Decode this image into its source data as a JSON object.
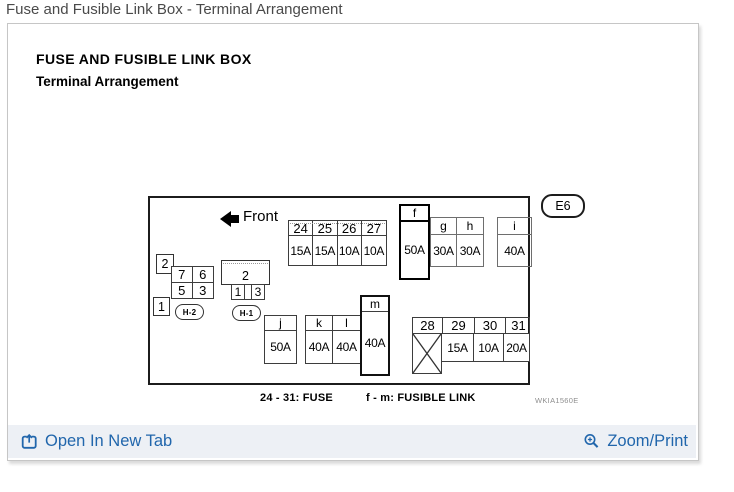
{
  "page_title": "Fuse and Fusible Link Box - Terminal Arrangement",
  "panel": {
    "title_line1": "FUSE AND FUSIBLE LINK BOX",
    "title_line2": "Terminal Arrangement"
  },
  "diagram": {
    "front_label": "Front",
    "badge": "E6",
    "watermark": "WKIA1560E",
    "legend_fuse": "24 - 31: FUSE",
    "legend_fusible": "f - m: FUSIBLE LINK",
    "fuse_top": {
      "ids": [
        "24",
        "25",
        "26",
        "27"
      ],
      "amps": [
        "15A",
        "15A",
        "10A",
        "10A"
      ]
    },
    "fuse_bottom": {
      "ids": [
        "28",
        "29",
        "30",
        "31"
      ],
      "amps": [
        "",
        "15A",
        "10A",
        "20A"
      ],
      "crossed_cell_id": "28"
    },
    "links": {
      "f": {
        "label": "f",
        "amp": "50A"
      },
      "g": {
        "label": "g",
        "amp": "30A"
      },
      "h": {
        "label": "h",
        "amp": "30A"
      },
      "i": {
        "label": "i",
        "amp": "40A"
      },
      "j": {
        "label": "j",
        "amp": "50A"
      },
      "k": {
        "label": "k",
        "amp": "40A"
      },
      "l": {
        "label": "l",
        "amp": "40A"
      },
      "m": {
        "label": "m",
        "amp": "40A"
      }
    },
    "relay_h2": {
      "tag_top": "2",
      "tag_bottom": "1",
      "cells": [
        "7",
        "6",
        "5",
        "3"
      ],
      "name": "H-2"
    },
    "relay_h1": {
      "top_label": "2",
      "cells": [
        "1",
        "3"
      ],
      "name": "H-1"
    }
  },
  "footer": {
    "open_label": "Open In New Tab",
    "zoom_label": "Zoom/Print"
  },
  "colors": {
    "link_blue": "#2166ac",
    "footer_bg": "#edf0f5",
    "panel_border": "#c6c6c6"
  }
}
